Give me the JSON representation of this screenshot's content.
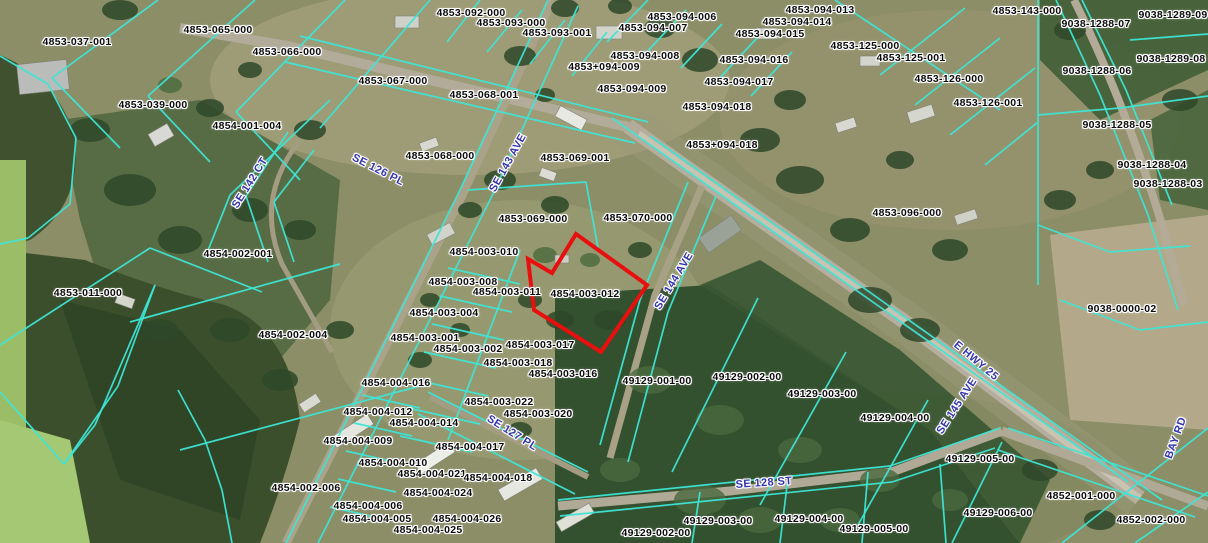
{
  "map": {
    "kind": "county-parcel-gis-aerial-view",
    "colors": {
      "parcel_line": "#3de6d6",
      "selected_parcel_outline": "#e80f0f",
      "parcel_label_text": "#0b0b0b",
      "street_label_text": "#3434ad",
      "label_halo": "#ffffff"
    },
    "selected_parcel": {
      "id": "4854-003-012",
      "points": [
        [
          576,
          234
        ],
        [
          647,
          285
        ],
        [
          601,
          352
        ],
        [
          534,
          310
        ],
        [
          528,
          259
        ],
        [
          552,
          273
        ]
      ]
    },
    "parcel_labels": [
      {
        "text": "4853-037-001",
        "x": 77,
        "y": 42
      },
      {
        "text": "4853-065-000",
        "x": 218,
        "y": 30
      },
      {
        "text": "4853-066-000",
        "x": 287,
        "y": 52
      },
      {
        "text": "4853-067-000",
        "x": 393,
        "y": 81
      },
      {
        "text": "4853-039-000",
        "x": 153,
        "y": 105
      },
      {
        "text": "4854-001-004",
        "x": 247,
        "y": 126
      },
      {
        "text": "4853-092-000",
        "x": 471,
        "y": 13
      },
      {
        "text": "4853-093-000",
        "x": 511,
        "y": 23
      },
      {
        "text": "4853-093-001",
        "x": 557,
        "y": 33
      },
      {
        "text": "4853-094-006",
        "x": 682,
        "y": 17
      },
      {
        "text": "4853-094-007",
        "x": 653,
        "y": 28
      },
      {
        "text": "4853-094-008",
        "x": 645,
        "y": 56
      },
      {
        "text": "4853+094-009",
        "x": 604,
        "y": 67
      },
      {
        "text": "4853-094-009",
        "x": 632,
        "y": 89
      },
      {
        "text": "4853-094-013",
        "x": 820,
        "y": 10
      },
      {
        "text": "4853-094-014",
        "x": 797,
        "y": 22
      },
      {
        "text": "4853-094-015",
        "x": 770,
        "y": 34
      },
      {
        "text": "4853-094-016",
        "x": 754,
        "y": 60
      },
      {
        "text": "4853-094-017",
        "x": 739,
        "y": 82
      },
      {
        "text": "4853-094-018",
        "x": 717,
        "y": 107
      },
      {
        "text": "4853+094-018",
        "x": 722,
        "y": 145
      },
      {
        "text": "4853-143-000",
        "x": 1027,
        "y": 11
      },
      {
        "text": "9038-1289-09",
        "x": 1173,
        "y": 15
      },
      {
        "text": "9038-1288-07",
        "x": 1096,
        "y": 24
      },
      {
        "text": "9038-1289-08",
        "x": 1171,
        "y": 59
      },
      {
        "text": "9038-1288-06",
        "x": 1097,
        "y": 71
      },
      {
        "text": "4853-125-000",
        "x": 865,
        "y": 46
      },
      {
        "text": "4853-125-001",
        "x": 911,
        "y": 58
      },
      {
        "text": "4853-126-000",
        "x": 949,
        "y": 79
      },
      {
        "text": "4853-126-001",
        "x": 988,
        "y": 103
      },
      {
        "text": "9038-1288-05",
        "x": 1117,
        "y": 125
      },
      {
        "text": "9038-1288-04",
        "x": 1152,
        "y": 165
      },
      {
        "text": "9038-1288-03",
        "x": 1168,
        "y": 184
      },
      {
        "text": "4853-068-001",
        "x": 484,
        "y": 95
      },
      {
        "text": "4853-068-000",
        "x": 440,
        "y": 156
      },
      {
        "text": "4853-069-001",
        "x": 575,
        "y": 158
      },
      {
        "text": "4853-069-000",
        "x": 533,
        "y": 219
      },
      {
        "text": "4853-070-000",
        "x": 638,
        "y": 218
      },
      {
        "text": "4853-096-000",
        "x": 907,
        "y": 213
      },
      {
        "text": "9038-0000-02",
        "x": 1122,
        "y": 309
      },
      {
        "text": "4854-002-001",
        "x": 238,
        "y": 254
      },
      {
        "text": "4853-011-000",
        "x": 88,
        "y": 293
      },
      {
        "text": "4854-002-004",
        "x": 293,
        "y": 335
      },
      {
        "text": "4854-003-010",
        "x": 484,
        "y": 252
      },
      {
        "text": "4854-003-008",
        "x": 463,
        "y": 282
      },
      {
        "text": "4854-003-011",
        "x": 507,
        "y": 292
      },
      {
        "text": "4854-003-012",
        "x": 585,
        "y": 294
      },
      {
        "text": "4854-003-004",
        "x": 444,
        "y": 313
      },
      {
        "text": "4854-003-001",
        "x": 425,
        "y": 338
      },
      {
        "text": "4854-003-002",
        "x": 468,
        "y": 349
      },
      {
        "text": "4854-003-017",
        "x": 540,
        "y": 345
      },
      {
        "text": "4854-003-018",
        "x": 518,
        "y": 363
      },
      {
        "text": "4854-003-016",
        "x": 563,
        "y": 374
      },
      {
        "text": "4854-004-016",
        "x": 396,
        "y": 383
      },
      {
        "text": "4854-004-012",
        "x": 378,
        "y": 412
      },
      {
        "text": "4854-004-014",
        "x": 424,
        "y": 423
      },
      {
        "text": "4854-003-022",
        "x": 499,
        "y": 402
      },
      {
        "text": "4854-003-020",
        "x": 538,
        "y": 414
      },
      {
        "text": "4854-004-009",
        "x": 358,
        "y": 441
      },
      {
        "text": "4854-004-017",
        "x": 470,
        "y": 447
      },
      {
        "text": "4854-004-010",
        "x": 393,
        "y": 463
      },
      {
        "text": "4854-004-021",
        "x": 432,
        "y": 474
      },
      {
        "text": "4854-004-018",
        "x": 498,
        "y": 478
      },
      {
        "text": "4854-002-006",
        "x": 306,
        "y": 488
      },
      {
        "text": "4854-004-024",
        "x": 438,
        "y": 493
      },
      {
        "text": "4854-004-006",
        "x": 368,
        "y": 506
      },
      {
        "text": "4854-004-005",
        "x": 377,
        "y": 519
      },
      {
        "text": "4854-004-026",
        "x": 467,
        "y": 519
      },
      {
        "text": "4854-004-025",
        "x": 428,
        "y": 530
      },
      {
        "text": "49129-001-00",
        "x": 657,
        "y": 381
      },
      {
        "text": "49129-002-00",
        "x": 747,
        "y": 377
      },
      {
        "text": "49129-003-00",
        "x": 822,
        "y": 394
      },
      {
        "text": "49129-004-00",
        "x": 895,
        "y": 418
      },
      {
        "text": "49129-005-00",
        "x": 980,
        "y": 459
      },
      {
        "text": "49129-006-00",
        "x": 998,
        "y": 513
      },
      {
        "text": "49129-002-00",
        "x": 656,
        "y": 533
      },
      {
        "text": "49129-003-00",
        "x": 718,
        "y": 521
      },
      {
        "text": "49129-004-00",
        "x": 809,
        "y": 519
      },
      {
        "text": "49129-005-00",
        "x": 874,
        "y": 529
      },
      {
        "text": "4852-001-000",
        "x": 1081,
        "y": 496
      },
      {
        "text": "4852-002-000",
        "x": 1151,
        "y": 520
      }
    ],
    "street_labels": [
      {
        "text": "SE 142 CT",
        "x": 250,
        "y": 183,
        "rot": -58
      },
      {
        "text": "SE 126 PL",
        "x": 378,
        "y": 170,
        "rot": 27
      },
      {
        "text": "SE 143 AVE",
        "x": 508,
        "y": 163,
        "rot": -61
      },
      {
        "text": "SE 144 AVE",
        "x": 674,
        "y": 281,
        "rot": -59
      },
      {
        "text": "E HWY 25",
        "x": 976,
        "y": 361,
        "rot": 40
      },
      {
        "text": "SE 145 AVE",
        "x": 957,
        "y": 406,
        "rot": -57
      },
      {
        "text": "BAY RD",
        "x": 1176,
        "y": 438,
        "rot": -70
      },
      {
        "text": "SE 127 PL",
        "x": 512,
        "y": 433,
        "rot": 32
      },
      {
        "text": "SE 128 ST",
        "x": 764,
        "y": 483,
        "rot": -4
      }
    ],
    "parcel_lines": [
      [
        158,
        0,
        52,
        78
      ],
      [
        52,
        78,
        120,
        148
      ],
      [
        255,
        0,
        148,
        96
      ],
      [
        345,
        0,
        236,
        112
      ],
      [
        430,
        0,
        320,
        128
      ],
      [
        148,
        96,
        210,
        162
      ],
      [
        236,
        112,
        300,
        180
      ],
      [
        300,
        36,
        648,
        122
      ],
      [
        285,
        62,
        635,
        143
      ],
      [
        0,
        56,
        48,
        84
      ],
      [
        48,
        84,
        76,
        138
      ],
      [
        76,
        138,
        70,
        204
      ],
      [
        70,
        204,
        28,
        238
      ],
      [
        28,
        238,
        0,
        244
      ],
      [
        0,
        345,
        150,
        248
      ],
      [
        150,
        248,
        262,
        292
      ],
      [
        330,
        100,
        230,
        195
      ],
      [
        230,
        195,
        205,
        258
      ],
      [
        288,
        132,
        246,
        196
      ],
      [
        246,
        196,
        268,
        262
      ],
      [
        314,
        150,
        274,
        202
      ],
      [
        274,
        202,
        294,
        262
      ],
      [
        130,
        322,
        340,
        264
      ],
      [
        180,
        450,
        420,
        386
      ],
      [
        155,
        285,
        95,
        425
      ],
      [
        95,
        425,
        64,
        464
      ],
      [
        0,
        392,
        64,
        464
      ],
      [
        64,
        464,
        118,
        386
      ],
      [
        118,
        386,
        155,
        285
      ],
      [
        178,
        390,
        205,
        440
      ],
      [
        205,
        440,
        222,
        490
      ],
      [
        222,
        490,
        232,
        543
      ],
      [
        548,
        0,
        460,
        190
      ],
      [
        460,
        190,
        286,
        543
      ],
      [
        578,
        6,
        492,
        196
      ],
      [
        492,
        196,
        318,
        543
      ],
      [
        480,
        0,
        447,
        42
      ],
      [
        522,
        10,
        487,
        52
      ],
      [
        565,
        20,
        530,
        64
      ],
      [
        607,
        32,
        572,
        76
      ],
      [
        648,
        0,
        607,
        42
      ],
      [
        686,
        10,
        645,
        54
      ],
      [
        722,
        24,
        681,
        68
      ],
      [
        757,
        38,
        716,
        82
      ],
      [
        792,
        52,
        751,
        96
      ],
      [
        835,
        0,
        1000,
        110
      ],
      [
        880,
        75,
        965,
        8
      ],
      [
        915,
        105,
        1000,
        38
      ],
      [
        950,
        135,
        1035,
        68
      ],
      [
        985,
        165,
        1038,
        122
      ],
      [
        1038,
        0,
        1038,
        285
      ],
      [
        1056,
        0,
        1100,
        95
      ],
      [
        1100,
        95,
        1148,
        215
      ],
      [
        1148,
        215,
        1178,
        310
      ],
      [
        1082,
        0,
        1126,
        90
      ],
      [
        1126,
        90,
        1172,
        205
      ],
      [
        1130,
        40,
        1208,
        34
      ],
      [
        1038,
        115,
        1120,
        108
      ],
      [
        1120,
        108,
        1208,
        96
      ],
      [
        1038,
        225,
        1110,
        252
      ],
      [
        1110,
        252,
        1190,
        246
      ],
      [
        1060,
        300,
        1140,
        330
      ],
      [
        1140,
        330,
        1208,
        322
      ],
      [
        612,
        118,
        1128,
        482
      ],
      [
        650,
        136,
        1162,
        500
      ],
      [
        688,
        182,
        640,
        300
      ],
      [
        640,
        300,
        600,
        445
      ],
      [
        716,
        196,
        668,
        312
      ],
      [
        668,
        312,
        628,
        462
      ],
      [
        468,
        190,
        586,
        182
      ],
      [
        586,
        182,
        598,
        248
      ],
      [
        448,
        268,
        520,
        284
      ],
      [
        440,
        296,
        512,
        312
      ],
      [
        432,
        324,
        504,
        340
      ],
      [
        424,
        352,
        496,
        368
      ],
      [
        416,
        380,
        488,
        396
      ],
      [
        408,
        408,
        480,
        424
      ],
      [
        400,
        436,
        472,
        452
      ],
      [
        520,
        250,
        448,
        440
      ],
      [
        362,
        395,
        420,
        408
      ],
      [
        354,
        423,
        412,
        436
      ],
      [
        346,
        451,
        404,
        464
      ],
      [
        338,
        479,
        396,
        492
      ],
      [
        330,
        507,
        388,
        520
      ],
      [
        428,
        392,
        588,
        472
      ],
      [
        418,
        414,
        575,
        494
      ],
      [
        758,
        298,
        672,
        472
      ],
      [
        846,
        352,
        760,
        505
      ],
      [
        928,
        400,
        858,
        525
      ],
      [
        1002,
        442,
        952,
        543
      ],
      [
        700,
        492,
        692,
        543
      ],
      [
        788,
        478,
        780,
        543
      ],
      [
        868,
        472,
        862,
        543
      ],
      [
        940,
        464,
        946,
        543
      ],
      [
        558,
        500,
        890,
        466
      ],
      [
        890,
        466,
        1000,
        428
      ],
      [
        560,
        516,
        892,
        482
      ],
      [
        892,
        482,
        995,
        448
      ],
      [
        1008,
        428,
        1208,
        496
      ],
      [
        998,
        450,
        1195,
        517
      ],
      [
        1208,
        428,
        1062,
        543
      ],
      [
        1208,
        492,
        1135,
        543
      ]
    ]
  }
}
